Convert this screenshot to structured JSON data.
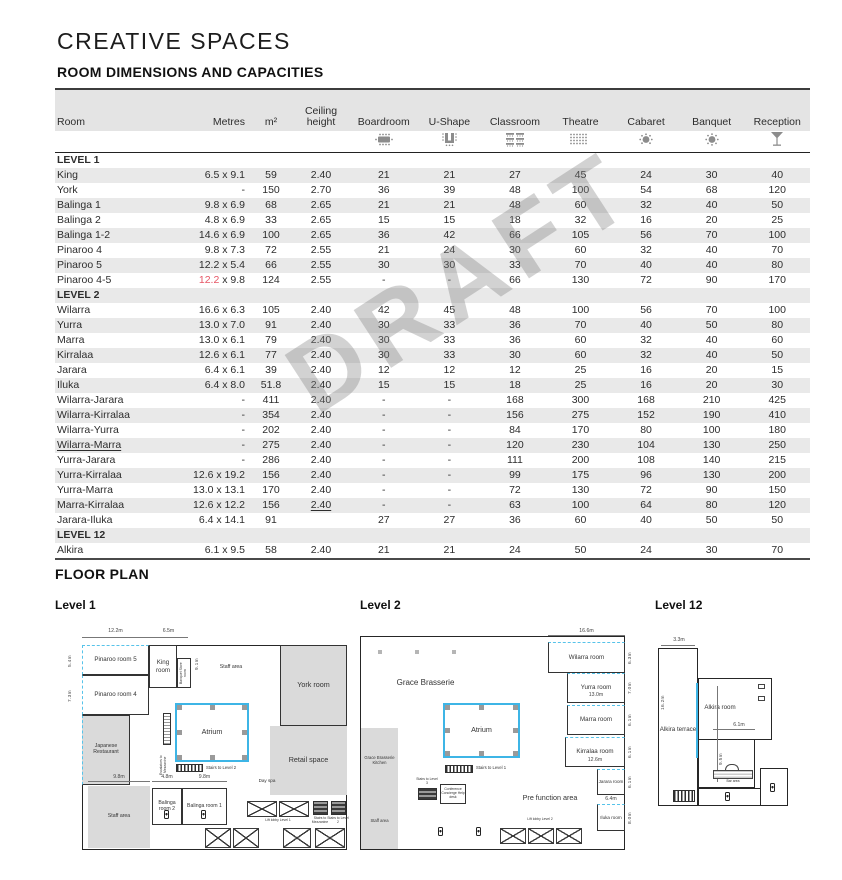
{
  "page": {
    "title": "CREATIVE SPACES",
    "subtitle": "ROOM DIMENSIONS AND CAPACITIES",
    "floorplan_title": "FLOOR PLAN",
    "watermark": "DRAFT"
  },
  "colors": {
    "accent_red": "#e65565",
    "accent_cyan": "#3db5e6",
    "shade_gray": "#e9e9e9"
  },
  "table": {
    "columns": [
      "Room",
      "Metres",
      "m²",
      "Ceiling height",
      "Boardroom",
      "U-Shape",
      "Classroom",
      "Theatre",
      "Cabaret",
      "Banquet",
      "Reception"
    ],
    "icon_names": [
      "boardroom-icon",
      "ushape-icon",
      "classroom-icon",
      "theatre-icon",
      "cabaret-icon",
      "banquet-icon",
      "reception-icon"
    ],
    "sections": [
      {
        "label": "LEVEL 1",
        "shaded": false,
        "rows": [
          {
            "cells": [
              "King",
              "6.5 x 9.1",
              "59",
              "2.40",
              "21",
              "21",
              "27",
              "45",
              "24",
              "30",
              "40"
            ]
          },
          {
            "cells": [
              "York",
              "-",
              "150",
              "2.70",
              "36",
              "39",
              "48",
              "100",
              "54",
              "68",
              "120"
            ]
          },
          {
            "cells": [
              "Balinga 1",
              "9.8 x 6.9",
              "68",
              "2.65",
              "21",
              "21",
              "48",
              "60",
              "32",
              "40",
              "50"
            ]
          },
          {
            "cells": [
              "Balinga 2",
              "4.8 x 6.9",
              "33",
              "2.65",
              "15",
              "15",
              "18",
              "32",
              "16",
              "20",
              "25"
            ]
          },
          {
            "cells": [
              "Balinga 1-2",
              "14.6 x 6.9",
              "100",
              "2.65",
              "36",
              "42",
              "66",
              "105",
              "56",
              "70",
              "100"
            ]
          },
          {
            "cells": [
              "Pinaroo 4",
              "9.8 x 7.3",
              "72",
              "2.55",
              "21",
              "24",
              "30",
              "60",
              "32",
              "40",
              "70"
            ]
          },
          {
            "cells": [
              "Pinaroo 5",
              "12.2 x 5.4",
              "66",
              "2.55",
              "30",
              "30",
              "33",
              "70",
              "40",
              "40",
              "80"
            ]
          },
          {
            "cells": [
              "Pinaroo 4-5",
              "12.2 x 9.8",
              "124",
              "2.55",
              "-",
              "-",
              "66",
              "130",
              "72",
              "90",
              "170"
            ],
            "red_prefix": "12.2"
          }
        ]
      },
      {
        "label": "LEVEL 2",
        "shaded": true,
        "rows": [
          {
            "cells": [
              "Wilarra",
              "16.6 x 6.3",
              "105",
              "2.40",
              "42",
              "45",
              "48",
              "100",
              "56",
              "70",
              "100"
            ]
          },
          {
            "cells": [
              "Yurra",
              "13.0 x 7.0",
              "91",
              "2.40",
              "30",
              "33",
              "36",
              "70",
              "40",
              "50",
              "80"
            ]
          },
          {
            "cells": [
              "Marra",
              "13.0 x 6.1",
              "79",
              "2.40",
              "30",
              "33",
              "36",
              "60",
              "32",
              "40",
              "60"
            ]
          },
          {
            "cells": [
              "Kirralaa",
              "12.6 x 6.1",
              "77",
              "2.40",
              "30",
              "33",
              "30",
              "60",
              "32",
              "40",
              "50"
            ]
          },
          {
            "cells": [
              "Jarara",
              "6.4 x 6.1",
              "39",
              "2.40",
              "12",
              "12",
              "12",
              "25",
              "16",
              "20",
              "15"
            ]
          },
          {
            "cells": [
              "Iluka",
              "6.4 x 8.0",
              "51.8",
              "2.40",
              "15",
              "15",
              "18",
              "25",
              "16",
              "20",
              "30"
            ]
          },
          {
            "cells": [
              "Wilarra-Jarara",
              "-",
              "411",
              "2.40",
              "-",
              "-",
              "168",
              "300",
              "168",
              "210",
              "425"
            ]
          },
          {
            "cells": [
              "Wilarra-Kirralaa",
              "-",
              "354",
              "2.40",
              "-",
              "-",
              "156",
              "275",
              "152",
              "190",
              "410"
            ]
          },
          {
            "cells": [
              "Wilarra-Yurra",
              "-",
              "202",
              "2.40",
              "-",
              "-",
              "84",
              "170",
              "80",
              "100",
              "180"
            ]
          },
          {
            "cells": [
              "Wilarra-Marra",
              "-",
              "275",
              "2.40",
              "-",
              "-",
              "120",
              "230",
              "104",
              "130",
              "250"
            ],
            "room_underline": true
          },
          {
            "cells": [
              "Yurra-Jarara",
              "-",
              "286",
              "2.40",
              "-",
              "-",
              "111",
              "200",
              "108",
              "140",
              "215"
            ]
          },
          {
            "cells": [
              "Yurra-Kirralaa",
              "12.6 x 19.2",
              "156",
              "2.40",
              "-",
              "-",
              "99",
              "175",
              "96",
              "130",
              "200"
            ]
          },
          {
            "cells": [
              "Yurra-Marra",
              "13.0 x 13.1",
              "170",
              "2.40",
              "-",
              "-",
              "72",
              "130",
              "72",
              "90",
              "150"
            ]
          },
          {
            "cells": [
              "Marra-Kirralaa",
              "12.6 x 12.2",
              "156",
              "2.40",
              "-",
              "-",
              "63",
              "100",
              "64",
              "80",
              "120"
            ],
            "ceiling_underline": true
          },
          {
            "cells": [
              "Jarara-Iluka",
              "6.4 x 14.1",
              "91",
              "",
              "27",
              "27",
              "36",
              "60",
              "40",
              "50",
              "50"
            ]
          }
        ]
      },
      {
        "label": "LEVEL 12",
        "shaded": true,
        "rows": [
          {
            "cells": [
              "Alkira",
              "6.1 x 9.5",
              "58",
              "2.40",
              "21",
              "21",
              "24",
              "50",
              "24",
              "30",
              "70"
            ]
          }
        ]
      }
    ]
  },
  "plans": {
    "level1": {
      "title": "Level 1",
      "labels": {
        "dim_12_2": "12.2m",
        "dim_6_5": "6.5m",
        "dim_5_4": "5.4m",
        "dim_7_3": "7.3m",
        "pinaroo5": "Pinaroo room 5",
        "pinaroo4": "Pinaroo room 4",
        "king": "King room",
        "banquet_store": "Banquet Store room",
        "dim_9_1": "9.1m",
        "staff_top": "Staff area",
        "york": "York room",
        "japanese": "Japanese Restaurant",
        "atrium": "Atrium",
        "escalators": "Escalators to Mezzanine",
        "stairs_l2": "Stairs to Level 2",
        "dim_4_8": "4.8m",
        "dim_9_8a": "9.8m",
        "dim_6_9": "6.9m",
        "dim_9_8b": "9.8m",
        "balinga2": "Balinga room 2",
        "balinga1": "Balinga room 1",
        "staff_bottom": "Staff area",
        "day_spa": "Day spa",
        "retail": "Retail space",
        "lift_lobby": "Lift lobby Level 1",
        "stairs_mezz": "Stairs to Mezzanine",
        "stairs_l2b": "Stairs to Level 2"
      }
    },
    "level2": {
      "title": "Level 2",
      "labels": {
        "grace": "Grace Brasserie",
        "grace_kitchen": "Grace Brasserie Kitchen",
        "staff": "Staff area",
        "atrium": "Atrium",
        "stairs_l1": "Stairs to Level 1",
        "stairs_l3": "Stairs to Level 3",
        "concierge": "Conference Concierge Help desk",
        "prefunction": "Pre function area",
        "lift_lobby": "Lift lobby Level 2",
        "dim_16_6": "16.6m",
        "wilarra": "Wilarra room",
        "dim_6_3": "6.3m",
        "yurra": "Yurra room",
        "dim_7_0": "7.0m",
        "dim_13_0": "13.0m",
        "marra": "Marra room",
        "dim_6_1a": "6.1m",
        "kirralaa": "Kirralaa room",
        "dim_6_1b": "6.1m",
        "dim_12_6": "12.6m",
        "jarara": "Jarara room",
        "dim_6_1c": "6.1m",
        "dim_6_4": "6.4m",
        "iluka": "Iluka room",
        "dim_8_0": "8.0m"
      }
    },
    "level12": {
      "title": "Level 12",
      "labels": {
        "dim_3_3": "3.3m",
        "dim_16_2": "16.2m",
        "terrace": "Alkira terrace",
        "room": "Alkira room",
        "dim_6_1": "6.1m",
        "dim_9_5": "9.5m",
        "bar": "Bar area"
      }
    }
  }
}
